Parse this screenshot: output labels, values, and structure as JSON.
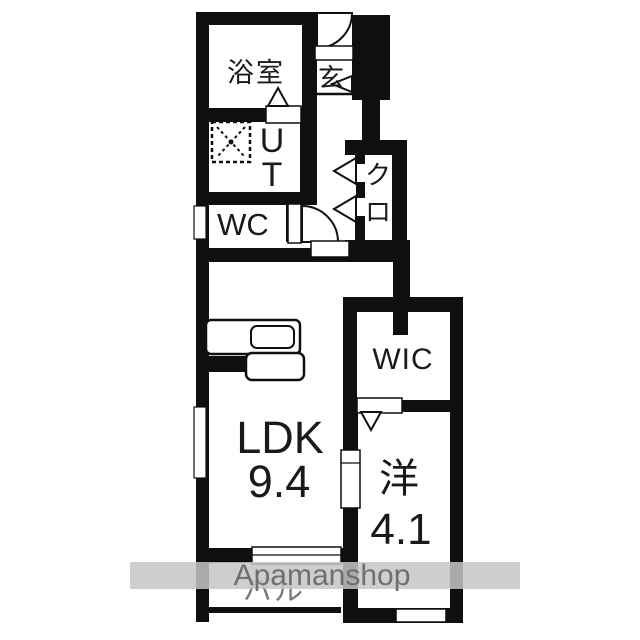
{
  "floorplan": {
    "rooms": {
      "bathroom": {
        "label": "浴室"
      },
      "entrance": {
        "label": "玄"
      },
      "utility": {
        "char1": "U",
        "char2": "T"
      },
      "toilet": {
        "label": "WC"
      },
      "closet": {
        "char1": "ク",
        "char2": "ロ"
      },
      "wic": {
        "label": "WIC"
      },
      "ldk": {
        "label": "LDK",
        "area": "9.4"
      },
      "western_room": {
        "label": "洋",
        "area": "4.1"
      },
      "balcony": {
        "label": "バル"
      }
    },
    "watermark": {
      "text": "Apamanshop"
    },
    "colors": {
      "wall": "#0f0f0f",
      "background": "#ffffff",
      "watermark_band": "#c5c5c5",
      "watermark_text": "#6f6f6f",
      "balcony_text": "#7a7a7a"
    }
  }
}
